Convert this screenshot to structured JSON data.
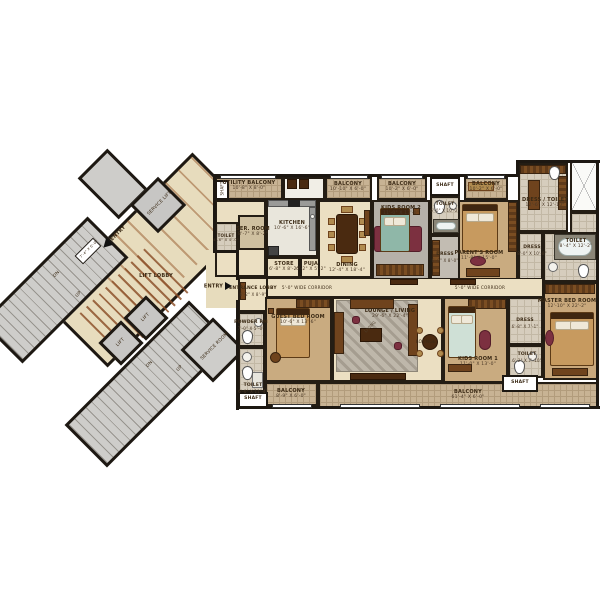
{
  "colors": {
    "wall": "#1d1812",
    "floor_cream": "#ebdfc2",
    "balcony_tile": "#c8b394",
    "carpet_tan": "#c9ab80",
    "carpet_gray": "#b6b1a9",
    "lobby_floor": "#e7dcbd",
    "stair_gray": "#cecdca",
    "accent_maroon": "#7c3040",
    "wood_brown": "#6f431d"
  },
  "rooms": {
    "utility_balcony": {
      "name": "UTILITY BALCONY",
      "dims": "10'-8\" X 8'-0\""
    },
    "ser_room": {
      "name": "SER. ROOM",
      "dims": "8'-7\" X 8'-2\""
    },
    "toilet_left": {
      "name": "TOILET",
      "dims": "4'-6\" X 4'-0\""
    },
    "kitchen": {
      "name": "KITCHEN",
      "dims": "10'-6\" X 16'-6\""
    },
    "store": {
      "name": "STORE",
      "dims": "6'-8\" X 8'-2\""
    },
    "puja": {
      "name": "PUJA",
      "dims": "6'-2\" X 5'-2\""
    },
    "dining": {
      "name": "DINING",
      "dims": "12'-4\" X 18'-4\""
    },
    "balcony_a": {
      "name": "BALCONY",
      "dims": "10'-10\" X 6'-0\""
    },
    "balcony_b": {
      "name": "BALCONY",
      "dims": "10'-2\" X 6'-0\""
    },
    "balcony_c": {
      "name": "BALCONY",
      "dims": "10'-2\" X 6'-0\""
    },
    "toilet_mid": {
      "name": "TOILET",
      "dims": "6'-0\" X 10'-2\""
    },
    "kids_room_2": {
      "name": "KIDS ROOM 2",
      "dims": "11'-0\" X 13'-0\""
    },
    "dress_mid": {
      "name": "DRESS",
      "dims": "6'-0\" X 8'-0\""
    },
    "parents_room": {
      "name": "PARENT'S ROOM",
      "dims": "11'-8\" X 15'-0\""
    },
    "dress_toilet": {
      "name": "DRESS / TOILET",
      "dims": "12'-6\" X 12'-10\""
    },
    "toilet_right": {
      "name": "TOILET",
      "dims": "8'-4\" X 12'-2\""
    },
    "dress_right": {
      "name": "DRESS",
      "dims": "8'-0\" X 10'-8\""
    },
    "master_bed": {
      "name": "MASTER BED ROOM",
      "dims": "12'-10\" X 22'-2\""
    },
    "dress_k1": {
      "name": "DRESS",
      "dims": "6'-8\" X 7'-1\""
    },
    "toilet_k1": {
      "name": "TOILET",
      "dims": "6'-2\" X 7'-10\""
    },
    "kids_room_1": {
      "name": "KIDS ROOM 1",
      "dims": "11'-0\" X 13'-0\""
    },
    "lounge_living": {
      "name": "LOUNGE / LIVING",
      "dims": "29'-6\" X 22'-4\""
    },
    "guest_bed": {
      "name": "GUEST BED ROOM",
      "dims": "10'-6\" X 13'-6\""
    },
    "powder_rm": {
      "name": "POWDER RM",
      "dims": "7'-0\" X 5'-0\""
    },
    "entrance_lobby": {
      "name": "ENTRANCE LOBBY",
      "dims": "6'-2\" X 8'-9\""
    },
    "toilet_guest": {
      "name": "TOILET",
      "dims": "6'-0\" X 11'-4\""
    },
    "balcony_guest": {
      "name": "BALCONY",
      "dims": "8'-9\" X 6'-0\""
    },
    "balcony_long": {
      "name": "BALCONY",
      "dims": "61'-4\" X 6'-0\""
    }
  },
  "labels": {
    "shaft": "SHAFT",
    "corridor": "5'-0\" WIDE CORRIDOR",
    "lift_lobby": "LIFT LOBBY",
    "entry": "ENTRY",
    "service_lift": "SERVICE LIFT",
    "service_room": "SERVICE ROOM",
    "lift": "LIFT",
    "up": "UP",
    "dn": "DN",
    "living": "LIVING",
    "lounge": "LOUNGE",
    "landing_dim": "7'-4\" X 6'-0\""
  }
}
